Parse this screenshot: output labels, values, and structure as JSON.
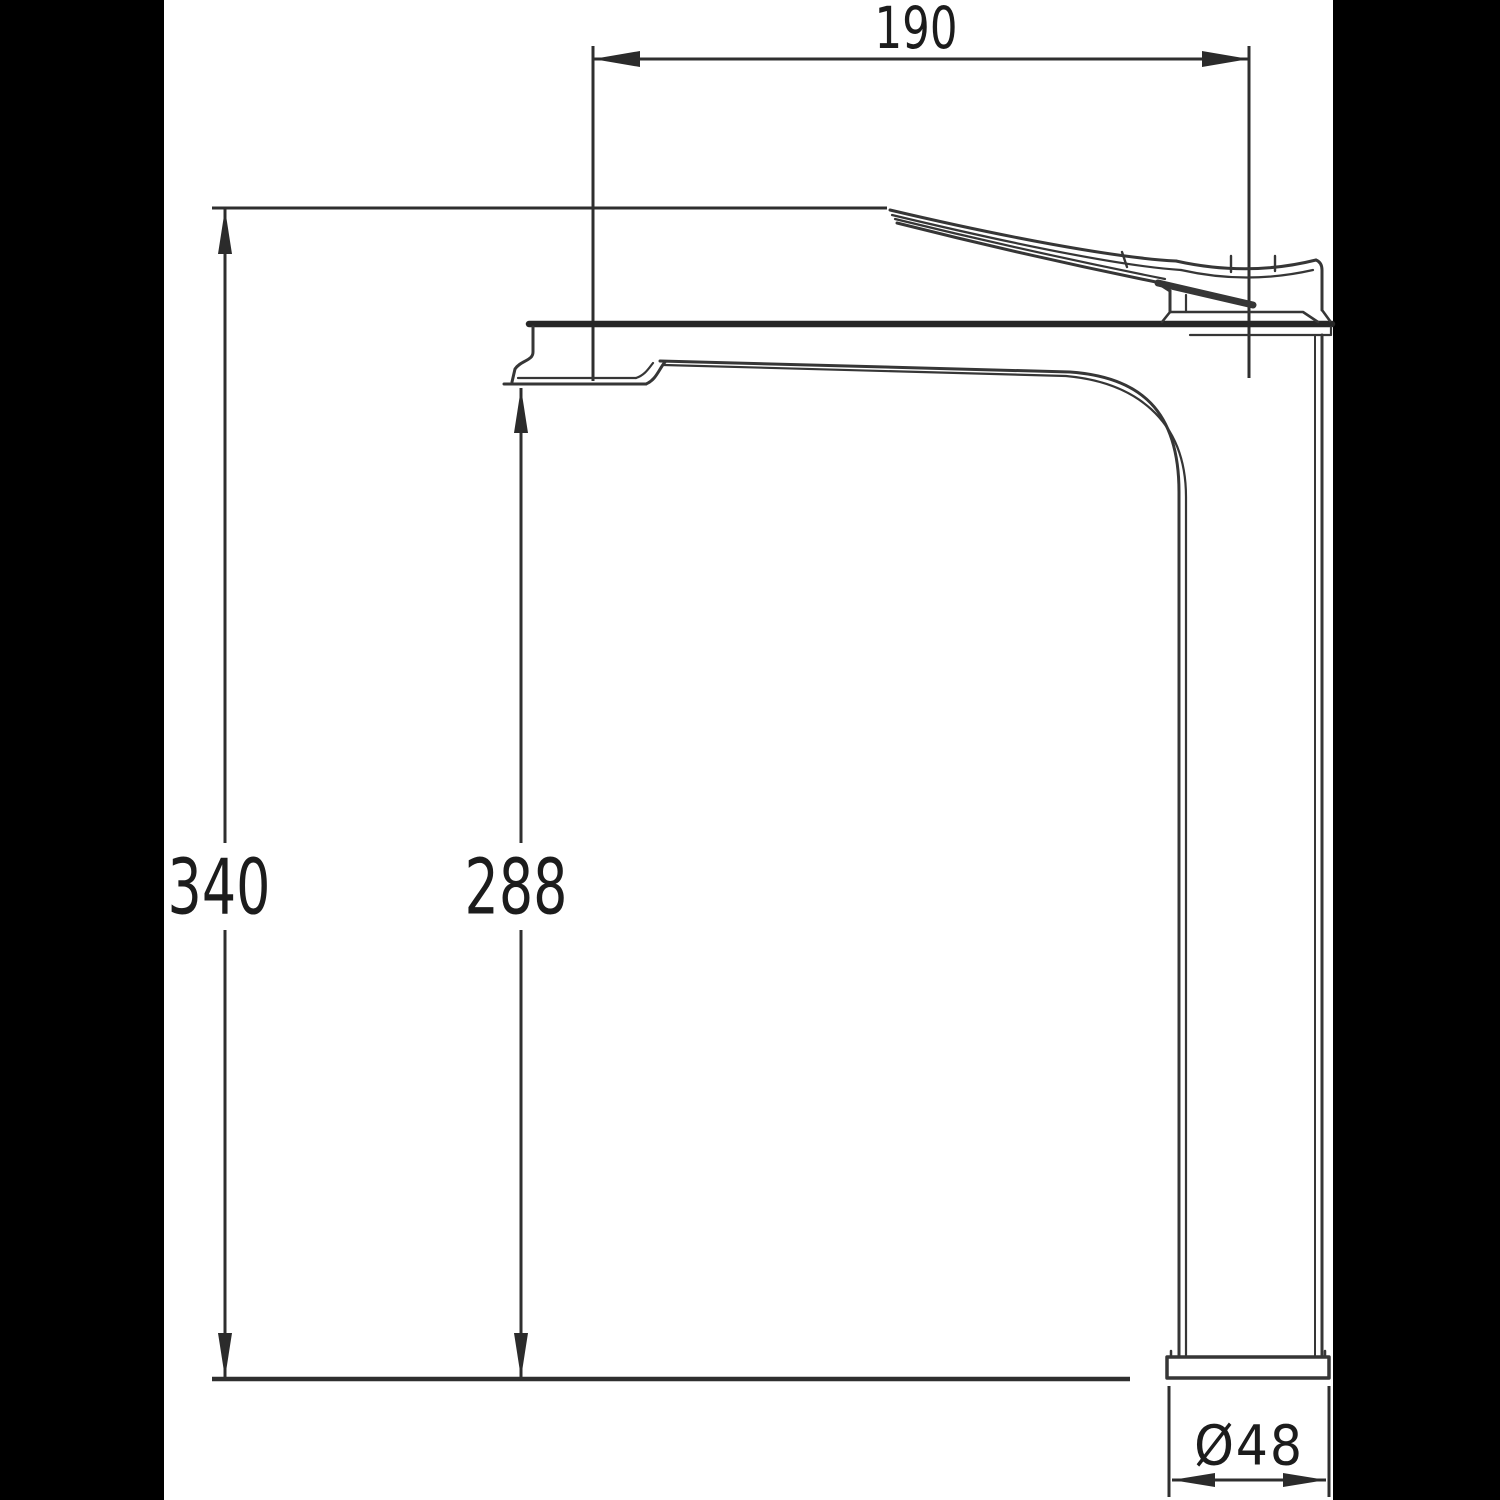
{
  "page": {
    "background_color": "#ffffff",
    "pillarbox_color": "#000000",
    "line_color": "#363636",
    "text_color": "#1c1c1c"
  },
  "dimensions": {
    "top_width": {
      "label": "190"
    },
    "overall_height": {
      "label": "340"
    },
    "spout_height": {
      "label": "288"
    },
    "base_diameter": {
      "label": "Ø48"
    }
  }
}
